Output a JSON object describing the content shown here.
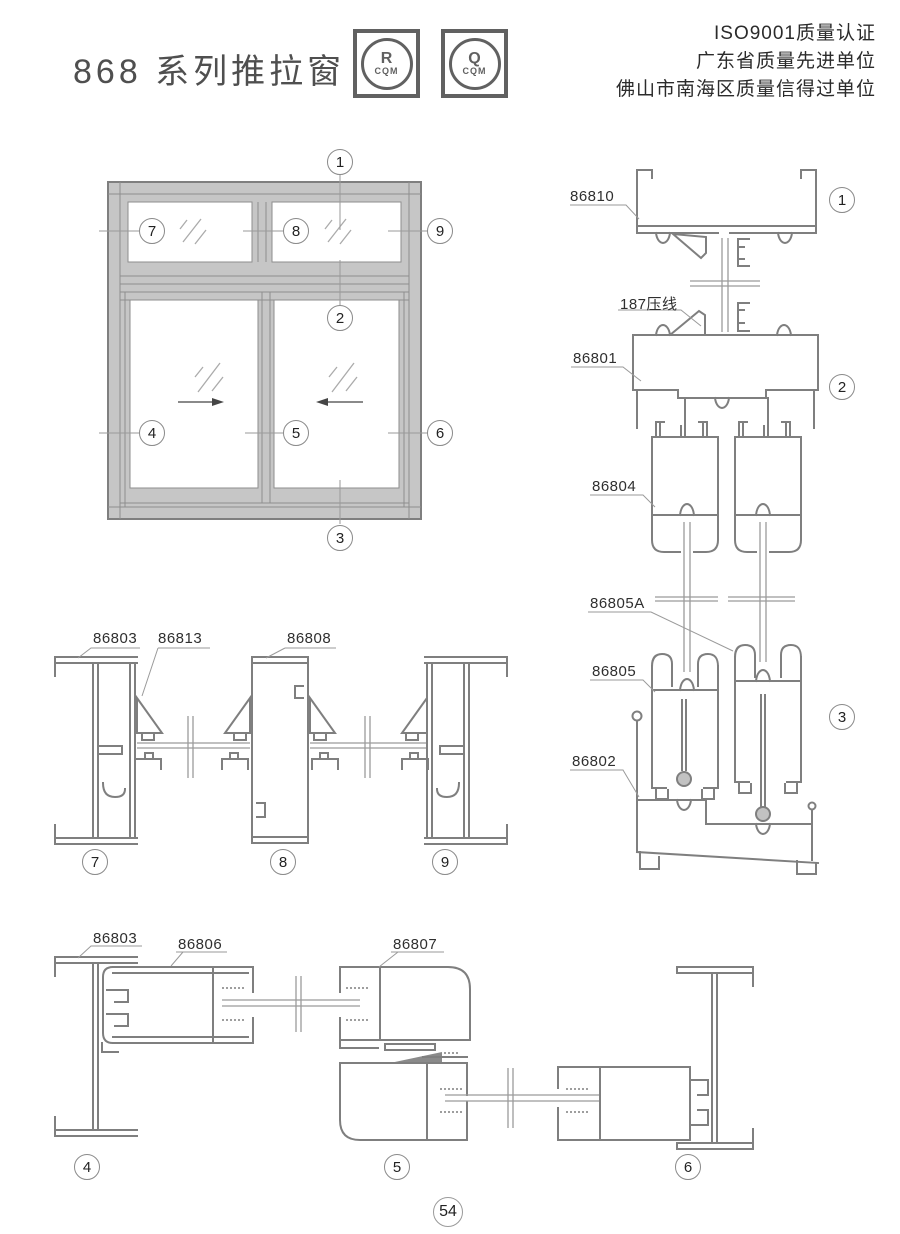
{
  "header": {
    "title": "868 系列推拉窗",
    "certifications": [
      "ISO9001质量认证",
      "广东省质量先进单位",
      "佛山市南海区质量信得过单位"
    ],
    "logos": [
      {
        "symbol": "R",
        "caption": "CQM"
      },
      {
        "symbol": "Q",
        "caption": "CQM"
      }
    ]
  },
  "part_labels": {
    "p86810": "86810",
    "p187": "187压线",
    "p86801": "86801",
    "p86804": "86804",
    "p86805a": "86805A",
    "p86805": "86805",
    "p86802": "86802",
    "p86803": "86803",
    "p86813": "86813",
    "p86808": "86808",
    "p86806": "86806",
    "p86807": "86807"
  },
  "callouts": {
    "n1": "1",
    "n2": "2",
    "n3": "3",
    "n4": "4",
    "n5": "5",
    "n6": "6",
    "n7": "7",
    "n8": "8",
    "n9": "9"
  },
  "page_number": "54"
}
